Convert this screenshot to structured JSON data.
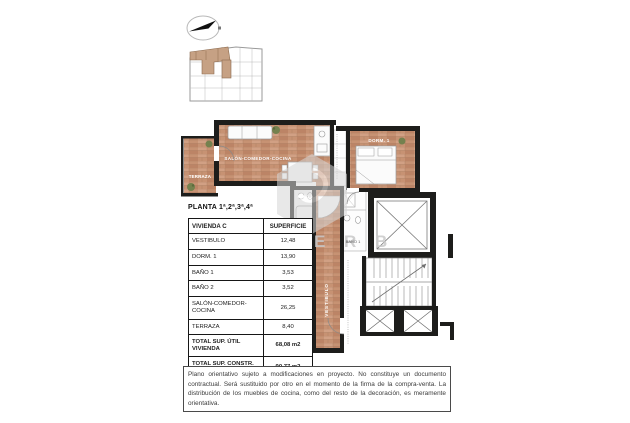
{
  "page": {
    "title": "PLANTA 1ª,2ª,3ª,4ª"
  },
  "table": {
    "header": {
      "name": "VIVIENDA C",
      "value": "SUPERFICIE"
    },
    "rows": [
      {
        "label": "VESTIBULO",
        "value": "12,48"
      },
      {
        "label": "DORM. 1",
        "value": "13,90"
      },
      {
        "label": "BAÑO 1",
        "value": "3,53"
      },
      {
        "label": "BAÑO 2",
        "value": "3,52"
      },
      {
        "label": "SALÓN-COMEDOR-COCINA",
        "value": "26,25"
      },
      {
        "label": "TERRAZA",
        "value": "8,40"
      }
    ],
    "totals": [
      {
        "label": "TOTAL SUP. ÚTIL VIVIENDA",
        "value": "68,08 m2"
      },
      {
        "label": "TOTAL SUP. CONSTR.\nVIV + PP +ZC",
        "value": "90,77 m2"
      }
    ]
  },
  "plan": {
    "room_labels": {
      "terraza": "TERRAZA",
      "salon": "SALÓN-COMEDOR-COCINA",
      "dorm1": "DORM. 1",
      "bano1": "BAÑO 1",
      "bano2": "BAÑO 2",
      "vestibulo": "VESTIBULO"
    },
    "watermark": "E R B",
    "colors": {
      "wood": "#c79273",
      "wall": "#1d1d1b",
      "unit_highlight": "#c6a184"
    }
  },
  "disclaimer": "Plano orientativo sujeto a modificaciones en proyecto. No constituye un documento contractual. Será sustituido por otro en el momento de la firma de la compra-venta. La distribución de los muebles de cocina, como del resto de la decoración, es meramente orientativa."
}
